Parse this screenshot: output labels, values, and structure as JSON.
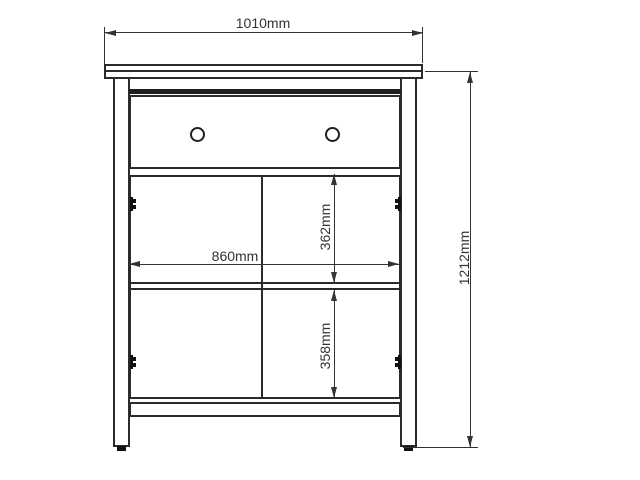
{
  "palette": {
    "background": "#ffffff",
    "structure_line": "#2b2b2b",
    "dimension_line": "#333333",
    "solid_fill": "#111111"
  },
  "dimensions": {
    "overall_width": "1010mm",
    "overall_height": "1212mm",
    "inner_width": "860mm",
    "upper_section_height": "362mm",
    "lower_section_height": "358mm"
  }
}
